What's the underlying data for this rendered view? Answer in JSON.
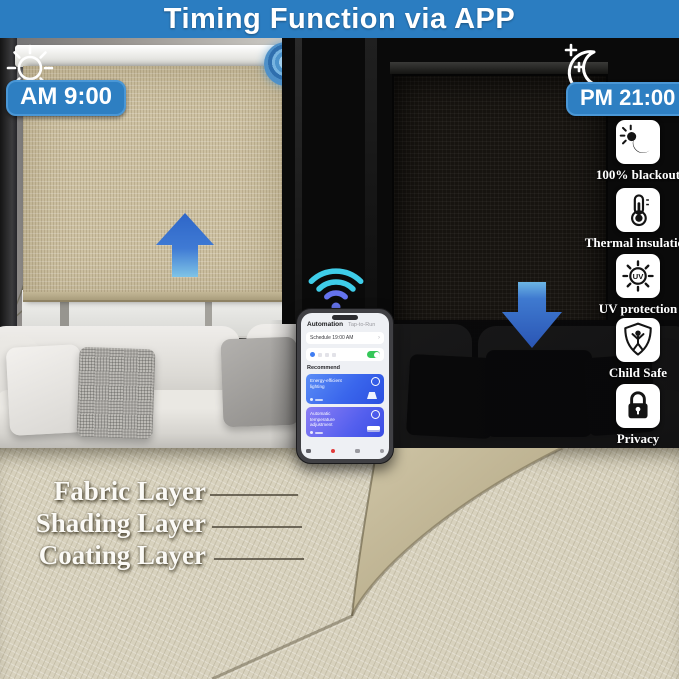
{
  "banner": {
    "title": "Timing Function via APP",
    "bg_color": "#2b7dc1"
  },
  "day": {
    "time": "AM 9:00",
    "icon": "sun-icon",
    "arrow": "arrow-up-icon"
  },
  "night": {
    "time": "PM 21:00",
    "icon": "moon-stars-icon",
    "arrow": "arrow-down-icon"
  },
  "connectivity": {
    "icon": "wifi-icon",
    "motor": "motor-hub-icon"
  },
  "features": [
    {
      "label": "100% blackout",
      "icon": "blackout-icon"
    },
    {
      "label": "Thermal insulation",
      "icon": "thermometer-icon"
    },
    {
      "label": "UV protection",
      "icon": "uv-sun-icon"
    },
    {
      "label": "Child Safe",
      "icon": "child-shield-icon"
    },
    {
      "label": "Privacy",
      "icon": "padlock-icon"
    }
  ],
  "phone": {
    "tab_automation": "Automation",
    "tab_taptorun": "Tap-to-Run",
    "schedule": "Schedule 19:00 AM",
    "chevron": "›",
    "recommend": "Recommend",
    "card1": "Energy-efficient lighting",
    "card2": "Automatic temperature adjustment"
  },
  "layers": [
    {
      "label": "Fabric Layer"
    },
    {
      "label": "Shading Layer"
    },
    {
      "label": "Coating Layer"
    }
  ],
  "colors": {
    "badge_blue": "#2e7fc2",
    "arrow_blue": "#3a6fce",
    "wifi_cyan": "#3fcde9",
    "wifi_violet": "#6573ee",
    "toggle_green": "#35c759"
  }
}
